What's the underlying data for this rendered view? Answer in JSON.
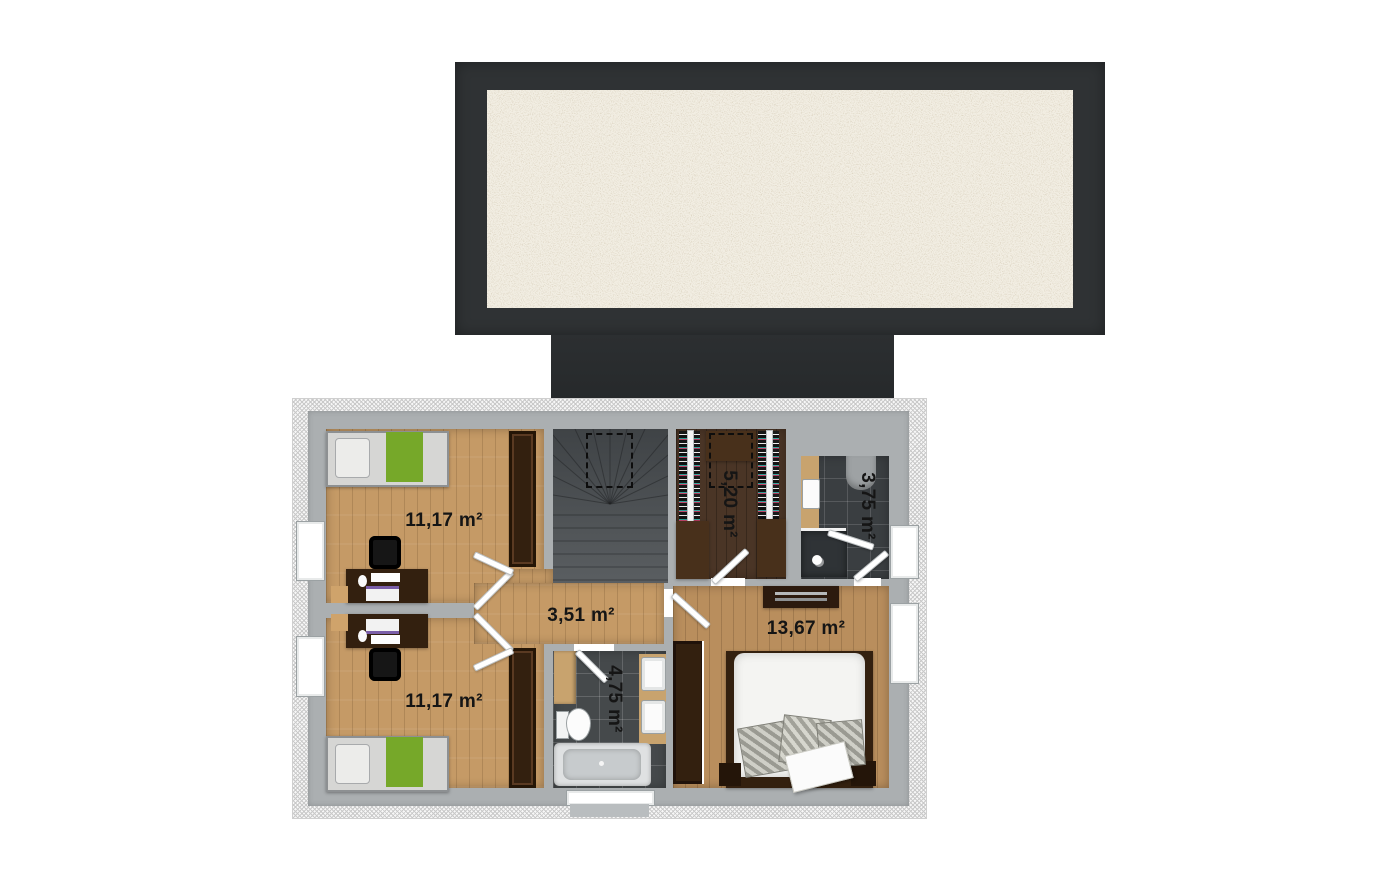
{
  "floorplan": {
    "title": "upper floor plan",
    "rooms": [
      {
        "id": "bedroom-top-left",
        "type": "bedroom",
        "area_label": "11,17 m²"
      },
      {
        "id": "bedroom-bottom-left",
        "type": "bedroom",
        "area_label": "11,17 m²"
      },
      {
        "id": "hallway",
        "type": "hall",
        "area_label": "3,51 m²"
      },
      {
        "id": "walk-in-closet",
        "type": "wardrobe",
        "area_label": "5,20 m²"
      },
      {
        "id": "shower-bathroom",
        "type": "bathroom",
        "area_label": "3,75 m²"
      },
      {
        "id": "main-bathroom",
        "type": "bathroom",
        "area_label": "4,75 m²"
      },
      {
        "id": "bedroom-right",
        "type": "master bedroom",
        "area_label": "13,67 m²"
      }
    ],
    "palette": {
      "roof_dark": "#2f3234",
      "roof_gravel": "#f2eee3",
      "wall_gray": "#abafb1",
      "wood_light": "#c59a66",
      "wood_dark": "#4a3526",
      "stair_gray": "#4b4f52",
      "tile_dark": "#43474a",
      "furniture_brown": "#33200f",
      "accent_green": "#76a829"
    }
  }
}
